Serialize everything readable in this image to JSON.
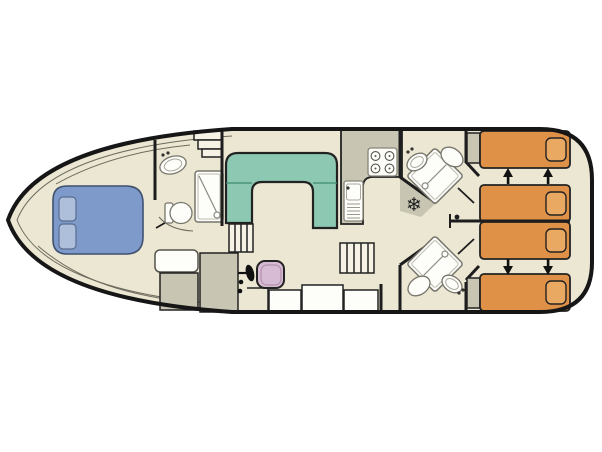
{
  "diagram": {
    "kind": "boat-floor-plan",
    "fridge_glyph": "❄"
  },
  "colors": {
    "background": "#ffffff",
    "floor": "#ece7d2",
    "hull_outline": "#161616",
    "counter_grey": "#c8c5b3",
    "wall": "#1d1d1d",
    "double_bed_blue": "#7d9aca",
    "double_bed_pillow": "#aebfdc",
    "sofa_green": "#8dc8b2",
    "helm_seat_pink": "#d7bad3",
    "single_bed_orange": "#de9147",
    "single_bed_pillow": "#e9a963",
    "fixture_white": "#fdfdfa",
    "steps_white": "#f6f3e6",
    "arrow_black": "#111111"
  }
}
